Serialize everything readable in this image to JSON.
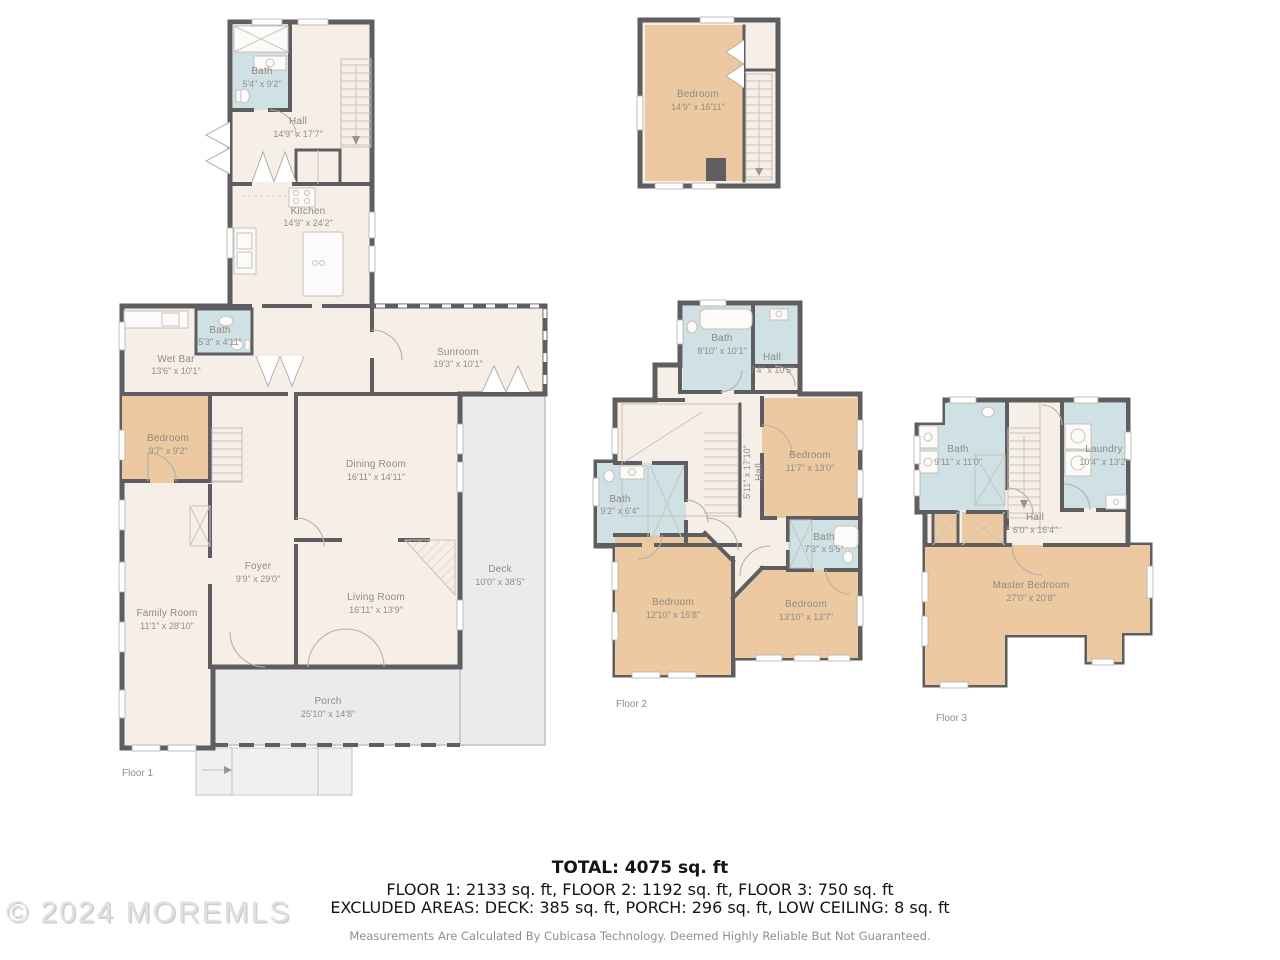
{
  "palette": {
    "wall": "#5e5e60",
    "room_fill": "#f6efe7",
    "bedroom_fill": "#ecc9a0",
    "bath_fill": "#cfe1e4",
    "outdoor_fill": "#ebebee",
    "label_text": "#8f8a83"
  },
  "watermark": "© 2024 MOREMLS",
  "summary": {
    "total": "TOTAL: 4075 sq. ft",
    "floors_line": "FLOOR 1: 2133 sq. ft, FLOOR 2: 1192 sq. ft, FLOOR 3: 750 sq. ft",
    "excluded_line": "EXCLUDED AREAS: DECK: 385 sq. ft, PORCH: 296 sq. ft, LOW CEILING: 8 sq. ft",
    "disclaimer": "Measurements Are Calculated By Cubicasa Technology. Deemed Highly Reliable But Not Guaranteed."
  },
  "floor1": {
    "label": "Floor 1",
    "rooms": {
      "bath_upper": {
        "name": "Bath",
        "dims": "5'4\" x 9'2\""
      },
      "hall": {
        "name": "Hall",
        "dims": "14'9\" x 17'7\""
      },
      "kitchen": {
        "name": "Kitchen",
        "dims": "14'9\" x 24'2\""
      },
      "bath_mid": {
        "name": "Bath",
        "dims": "5'3\" x 4'11\""
      },
      "wet_bar": {
        "name": "Wet Bar",
        "dims": "13'6\" x 10'1\""
      },
      "sunroom": {
        "name": "Sunroom",
        "dims": "19'3\" x 10'1\""
      },
      "bedroom": {
        "name": "Bedroom",
        "dims": "9'7\" x 9'2\""
      },
      "dining_room": {
        "name": "Dining Room",
        "dims": "16'11\" x 14'11\""
      },
      "foyer": {
        "name": "Foyer",
        "dims": "9'9\" x 29'0\""
      },
      "deck": {
        "name": "Deck",
        "dims": "10'0\" x 38'5\""
      },
      "living_room": {
        "name": "Living Room",
        "dims": "16'11\" x 13'9\""
      },
      "family_room": {
        "name": "Family Room",
        "dims": "11'1\" x 28'10\""
      },
      "porch": {
        "name": "Porch",
        "dims": "25'10\" x 14'8\""
      }
    }
  },
  "floor2": {
    "label": "Floor 2",
    "rooms": {
      "bedroom_top": {
        "name": "Bedroom",
        "dims": "14'9\" x 16'11\""
      },
      "bath_top": {
        "name": "Bath",
        "dims": "8'10\" x 10'1\""
      },
      "hall_top": {
        "name": "Hall",
        "dims": "7'4\" x 10'5\""
      },
      "bedroom_right": {
        "name": "Bedroom",
        "dims": "11'7\" x 13'0\""
      },
      "hall_mid": {
        "name": "Hall",
        "dims": "5'11\" x 17'10\""
      },
      "bath_left": {
        "name": "Bath",
        "dims": "9'2\" x 6'4\""
      },
      "bath_small": {
        "name": "Bath",
        "dims": "7'3\" x 5'5\""
      },
      "bedroom_bl": {
        "name": "Bedroom",
        "dims": "12'10\" x 15'8\""
      },
      "bedroom_br": {
        "name": "Bedroom",
        "dims": "13'10\" x 13'7\""
      }
    }
  },
  "floor3": {
    "label": "Floor 3",
    "rooms": {
      "bath": {
        "name": "Bath",
        "dims": "9'11\" x 11'0\""
      },
      "laundry": {
        "name": "Laundry",
        "dims": "10'4\" x 13'2\""
      },
      "hall": {
        "name": "Hall",
        "dims": "6'0\" x 16'4\""
      },
      "master_bedroom": {
        "name": "Master Bedroom",
        "dims": "27'0\" x 20'8\""
      }
    }
  }
}
